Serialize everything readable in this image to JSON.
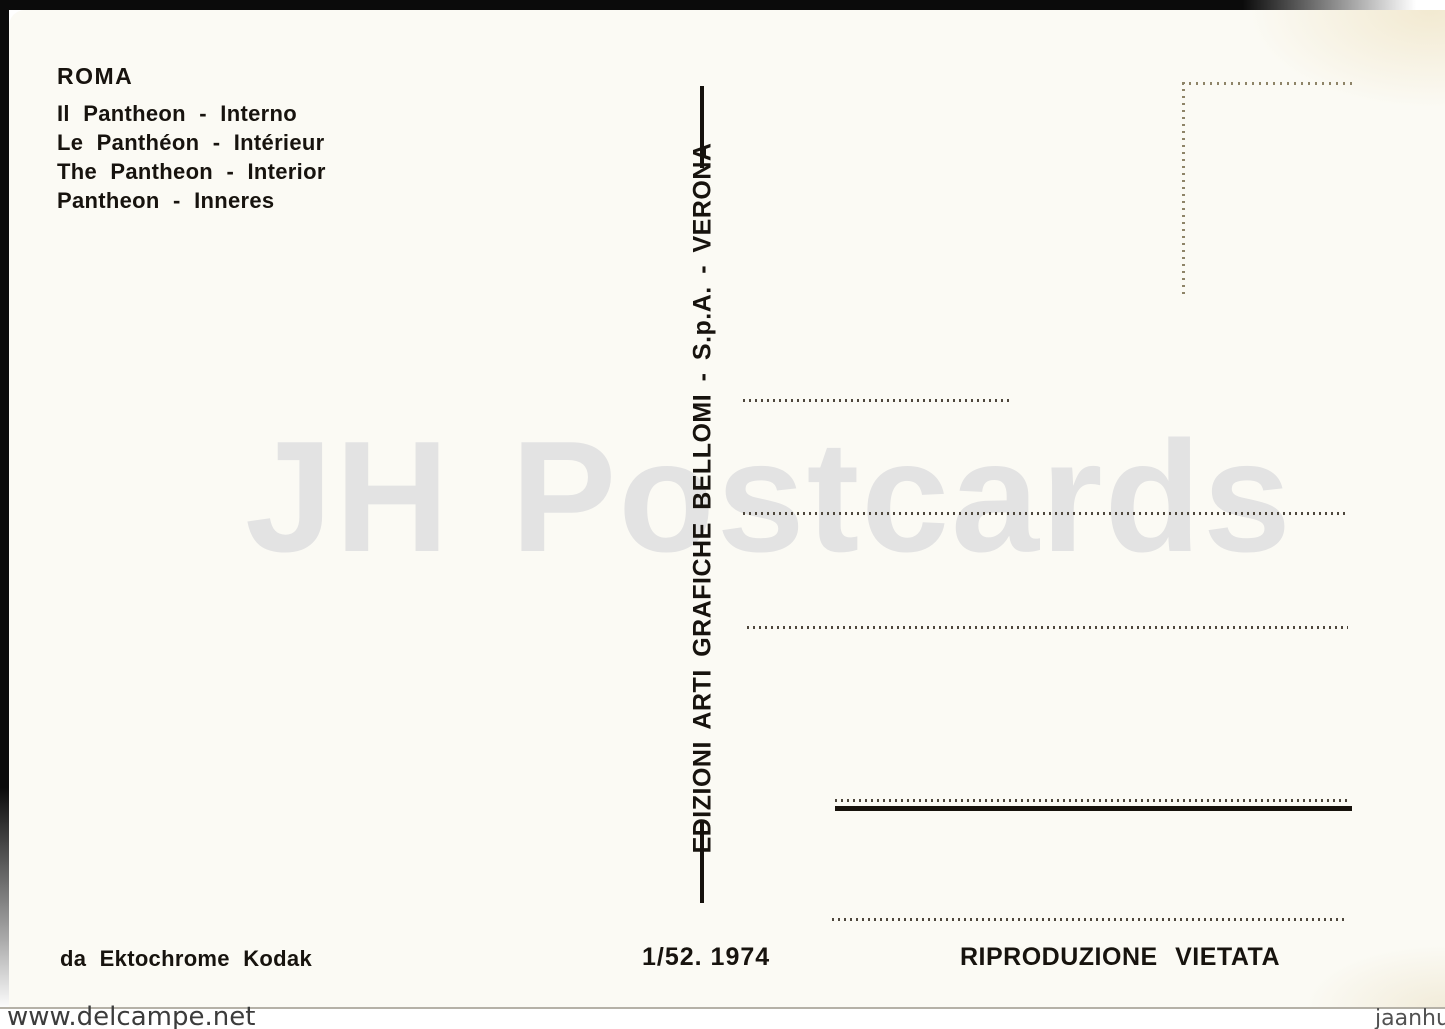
{
  "colors": {
    "card_background": "#fbfaf4",
    "ink_black": "#17130e",
    "jh_watermark_gray": "#e3e3e3",
    "dotted_line": "#4e473d",
    "stamp_box_dots": "#8e8468",
    "scan_background": "#0b0b0b",
    "site_watermark_gray": "#3c3c3c"
  },
  "card": {
    "title_block": {
      "city": "ROMA",
      "captions": [
        "Il Pantheon - Interno",
        "Le Panthéon - Intérieur",
        "The Pantheon - Interior",
        "Pantheon - Inneres"
      ]
    },
    "publisher_vertical": "EDIZIONI ARTI GRAFICHE BELLOMI - S.p.A. - VERONA",
    "watermark": "JH Postcards",
    "footer": {
      "film_credit": "da Ektochrome Kodak",
      "series_number": "1/52. 1974",
      "rights": "RIPRODUZIONE VIETATA"
    }
  },
  "overlays": {
    "site_watermark_left": "www.delcampe.net",
    "site_watermark_right": "jaanhus"
  }
}
